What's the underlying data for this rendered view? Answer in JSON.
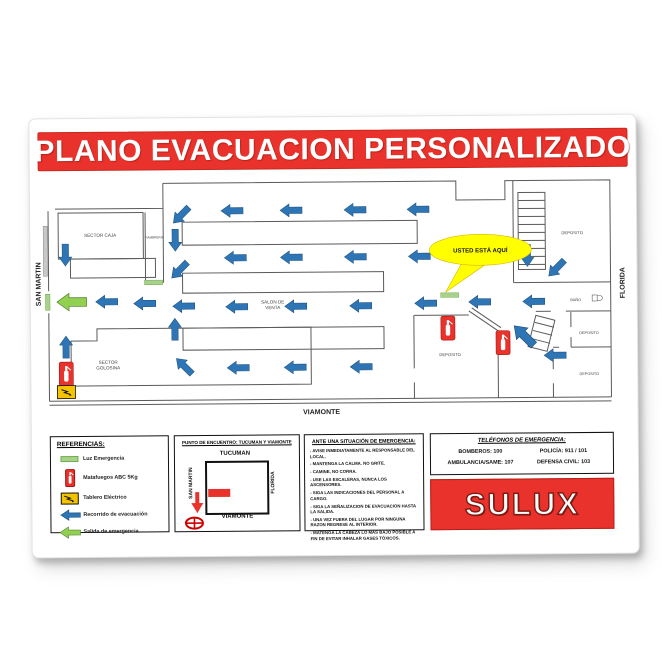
{
  "poster": {
    "title": "PLANO EVACUACION PERSONALIZADO",
    "logo": "SULUX",
    "colors": {
      "red": "#E9322B",
      "blue": "#2E75B6",
      "green": "#92D050",
      "yellow": "#FFFF00"
    }
  },
  "plan": {
    "streets": {
      "left": "SAN MARTIN",
      "right": "FLORIDA",
      "bottom": "VIAMONTE"
    },
    "you_are_here": "USTED ESTÁ AQUÍ",
    "room_labels": [
      {
        "lines": [
          "SECTOR CAJA"
        ],
        "x": 70,
        "y": 118,
        "size": 4.6
      },
      {
        "lines": [
          "FIAMBRERIA"
        ],
        "x": 124,
        "y": 120,
        "size": 3.1
      },
      {
        "lines": [
          "SALON DE",
          "VENTA"
        ],
        "x": 242,
        "y": 186,
        "size": 4.6
      },
      {
        "lines": [
          "SECTOR",
          "GOLOSINA"
        ],
        "x": 77,
        "y": 245,
        "size": 4.6
      },
      {
        "lines": [
          "DEPOSITO"
        ],
        "x": 542,
        "y": 119,
        "size": 4.2
      },
      {
        "lines": [
          "BAÑO"
        ],
        "x": 545,
        "y": 186,
        "size": 3.8
      },
      {
        "lines": [
          "DEPOSITO"
        ],
        "x": 558,
        "y": 219,
        "size": 3.8
      },
      {
        "lines": [
          "DEPOSITO"
        ],
        "x": 558,
        "y": 260,
        "size": 3.8
      },
      {
        "lines": [
          "DEPOSITO"
        ],
        "x": 419,
        "y": 240,
        "size": 4.2
      }
    ],
    "walls": [
      "M133,65 H426 V84 H475 V65 H580 V282",
      "M18,282 H580",
      "M18,286 H580",
      "M25,90 H133 V65",
      "M18,92 V172",
      "M18,194 V282",
      "M28,94 H113 V140 H28 Z",
      "M40,140 H125 V159 H40 Z",
      "M115,94 V164 H133",
      "M133,90 V164",
      "M152,104 H387 V127 H152 Z",
      "M152,155 H353 V175 H152 Z",
      "M152,210 H353 V232 H152 Z",
      "M483,65 V167",
      "M483,167 H580",
      "M488,77 H515 V154 H488 Z",
      "M488,85 H515",
      "M488,93 H515",
      "M488,101 H515",
      "M488,109 H515",
      "M488,117 H515",
      "M488,125 H515",
      "M488,133 H515",
      "M488,141 H515",
      "M488,149 H515",
      "M505,196 H520",
      "M535,196 H580",
      "M540,197 V212",
      "M540,222 V232",
      "M522,232 H528",
      "M540,232 H580",
      "M522,236 V254",
      "M522,268 V282",
      "M383,199 V252",
      "M383,266 V282",
      "M383,199 H438",
      "M438,195 L467,215",
      "M441,192 L470,212",
      "M467,215 V282",
      "M40,222 H66 V210 H280 V267 H40 Z",
      "M497,231 L505,200 L524,205 L516,236 Z",
      "M500,223 L519,228",
      "M502,215 L521,220",
      "M504,207 L523,212"
    ],
    "arrows": [
      {
        "x": 202,
        "y": 93
      },
      {
        "x": 261,
        "y": 93
      },
      {
        "x": 325,
        "y": 93
      },
      {
        "x": 388,
        "y": 93
      },
      {
        "x": 151,
        "y": 97,
        "r": -45
      },
      {
        "x": 145,
        "y": 122,
        "r": -90
      },
      {
        "x": 35,
        "y": 136,
        "r": -90
      },
      {
        "x": 205,
        "y": 140
      },
      {
        "x": 261,
        "y": 140
      },
      {
        "x": 325,
        "y": 140
      },
      {
        "x": 389,
        "y": 140
      },
      {
        "x": 149,
        "y": 152,
        "r": -45
      },
      {
        "x": 497,
        "y": 140,
        "r": -90
      },
      {
        "x": 526,
        "y": 153,
        "r": -45
      },
      {
        "x": 41,
        "y": 183,
        "c": "g",
        "s": 1.35
      },
      {
        "x": 76,
        "y": 183
      },
      {
        "x": 114,
        "y": 185
      },
      {
        "x": 153,
        "y": 188
      },
      {
        "x": 206,
        "y": 189
      },
      {
        "x": 265,
        "y": 189
      },
      {
        "x": 330,
        "y": 189
      },
      {
        "x": 395,
        "y": 187
      },
      {
        "x": 449,
        "y": 186
      },
      {
        "x": 503,
        "y": 186
      },
      {
        "x": 144,
        "y": 211,
        "r": 90
      },
      {
        "x": 35,
        "y": 228,
        "r": 90
      },
      {
        "x": 207,
        "y": 250
      },
      {
        "x": 264,
        "y": 250
      },
      {
        "x": 330,
        "y": 250
      },
      {
        "x": 153,
        "y": 248,
        "r": 45
      },
      {
        "x": 493,
        "y": 220,
        "r": 45,
        "s": 1.25
      },
      {
        "x": 524,
        "y": 240
      }
    ],
    "extinguishers": [
      {
        "x": 35,
        "y": 255
      },
      {
        "x": 417,
        "y": 212
      },
      {
        "x": 472,
        "y": 227
      }
    ],
    "lights": [
      {
        "x": 123,
        "y": 164,
        "o": "h"
      },
      {
        "x": 419,
        "y": 179,
        "o": "h"
      },
      {
        "x": 17,
        "y": 183,
        "o": "v"
      }
    ],
    "panels": [
      {
        "x": 35,
        "y": 273
      }
    ]
  },
  "legend": {
    "title": "REFERENCIAS:",
    "items": [
      {
        "icon": "emergency-light",
        "label": "Luz Emergencia"
      },
      {
        "icon": "extinguisher",
        "label": "Matafuegos ABC 5Kg"
      },
      {
        "icon": "electric-panel",
        "label": "Tablero Eléctrico"
      },
      {
        "icon": "evac-arrow",
        "label": "Recorrido de evacuación"
      },
      {
        "icon": "exit-arrow",
        "label": "Salida de emergencia"
      }
    ]
  },
  "meeting_point": {
    "title": "PUNTO DE ENCUENTRO: TUCUMAN Y VIAMONTE",
    "streets": {
      "top": "TUCUMAN",
      "bottom": "VIAMONTE",
      "left": "SAN MARTIN",
      "right": "FLORIDA"
    }
  },
  "instructions": {
    "title": "ANTE UNA SITUACIÓN DE EMERGENCIA:",
    "items": [
      "AVISE INMEDIATAMENTE AL RESPONSABLE DEL LOCAL.",
      "MANTENGA LA CALMA. NO GRITE.",
      "CAMINE, NO CORRA.",
      "USE LAS ESCALERAS, NUNCA LOS ASCENSORES.",
      "SIGA LAS INDICACIONES DEL PERSONAL A CARGO.",
      "SIGA LA SEÑALIZACION DE EVACUACION HASTA LA SALIDA.",
      "UNA VEZ FUERA DEL LUGAR POR NINGUNA RAZON REGRESE AL INTERIOR.",
      "MATENGA LA CABEZA LO MÁS BAJO POSIBLE A FIN DE EVITAR INHALAR GASES TÓXICOS."
    ]
  },
  "phones": {
    "title": "TELÉFONOS DE EMERGENCIA:",
    "entries": [
      "BOMBEROS: 100",
      "POLICÍA: 911 / 101",
      "AMBULANCIA/SAME: 107",
      "DEFENSA CIVIL: 103"
    ]
  }
}
